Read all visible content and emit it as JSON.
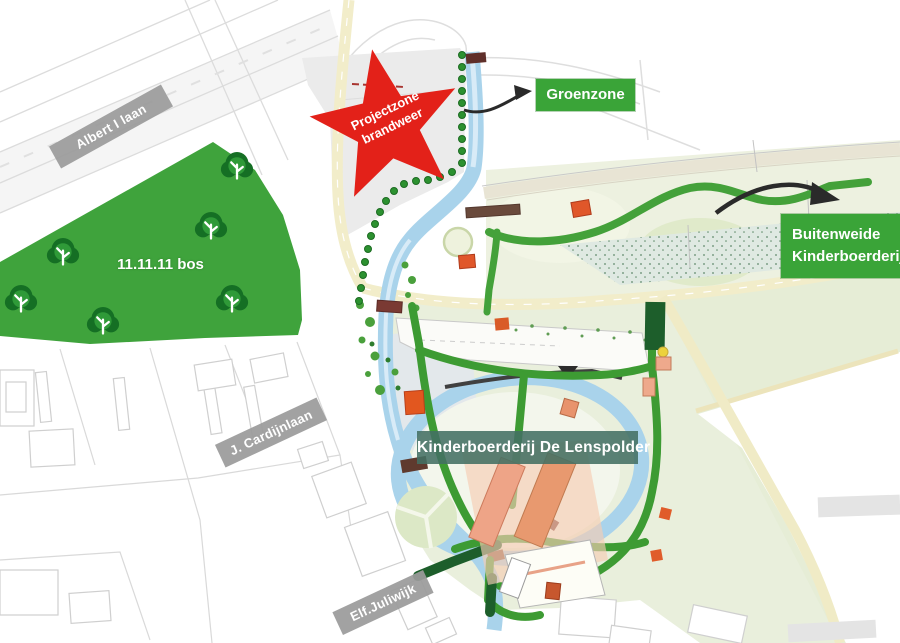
{
  "map": {
    "streets": {
      "albert": "Albert I laan",
      "cardijn": "J. Cardijnlaan",
      "juliwijk": "Elf.Juliwijk"
    },
    "zones": {
      "groenzone": "Groenzone",
      "buitenweide_line1": "Buitenweide",
      "buitenweide_line2": "Kinderboerderij",
      "farm": "Kinderboerderij De Lenspolder",
      "bos": "11.11.11 bos",
      "star_line1": "Projectzone",
      "star_line2": "brandweer"
    },
    "colors": {
      "accent_green": "#3aa438",
      "forest_green": "#3fa33c",
      "star_red": "#e32119",
      "canal_blue": "#a9d3eb",
      "road_yellow": "#f2edca",
      "street_label_gray": "#9e9e9e",
      "farm_label_teal": "#477066"
    }
  }
}
